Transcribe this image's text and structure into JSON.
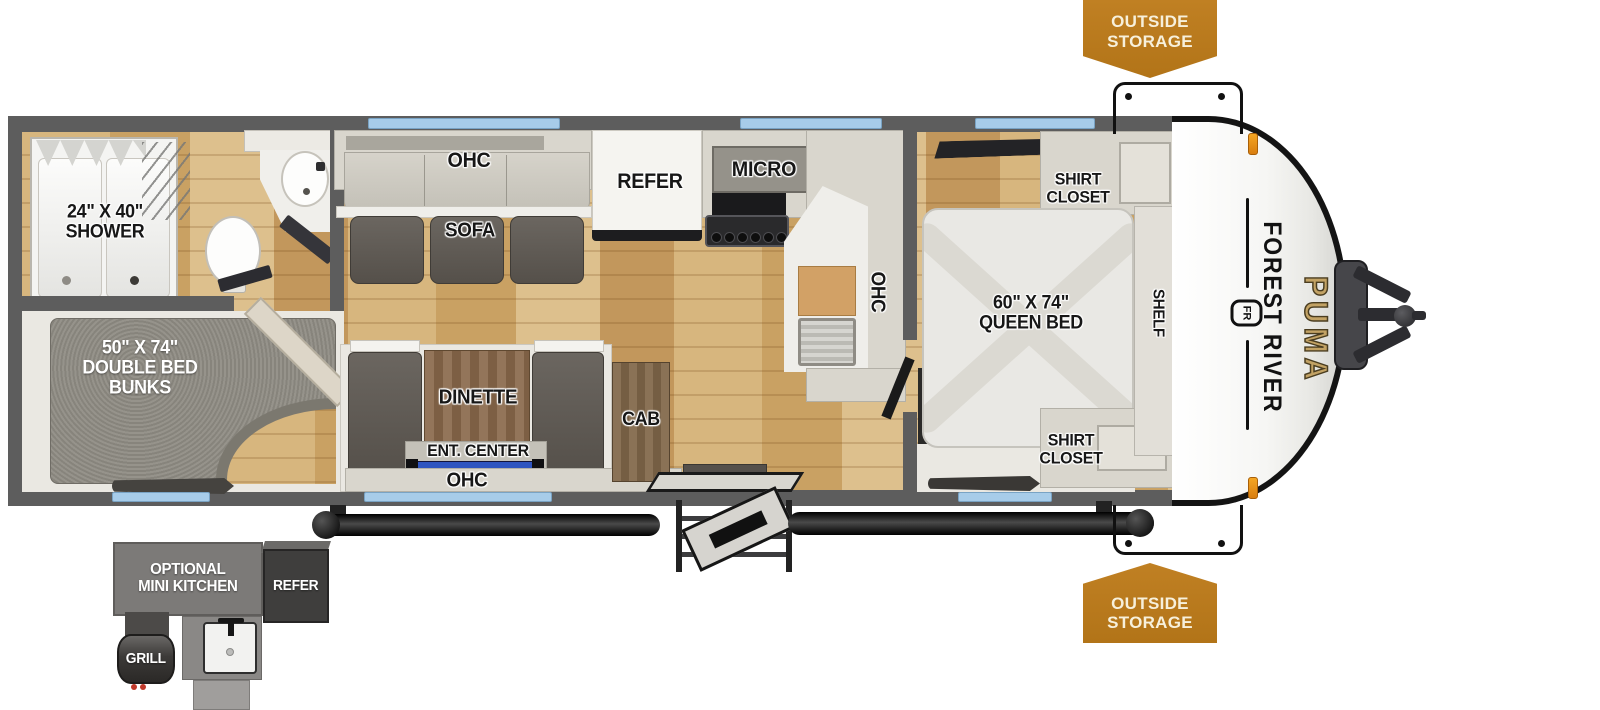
{
  "title": "Forest River Puma travel trailer floorplan",
  "colors": {
    "badge_orange": "#bd7b22",
    "window_blue": "#a7cce9",
    "wall_gray": "#5d5d5d",
    "wood_tan": "#d2ad74",
    "carpet_gray": "#8f8c84",
    "puma_gold": "#c2a264",
    "tv_blue": "#2f55c0"
  },
  "badges": {
    "outside_storage": "OUTSIDE\nSTORAGE"
  },
  "rooms": {
    "bathroom": {
      "shower": "24\" X 40\"\nSHOWER"
    },
    "bunk_room": {
      "bunks": "50\" X 74\"\nDOUBLE BED\nBUNKS"
    },
    "living": {
      "ohc_top": "OHC",
      "sofa": "SOFA",
      "refer": "REFER",
      "micro": "MICRO",
      "ohc_kitchen": "OHC",
      "dinette": "DINETTE",
      "ent_center": "ENT. CENTER",
      "cab": "CAB",
      "ohc_bottom": "OHC"
    },
    "bedroom": {
      "shirt_closet_top": "SHIRT\nCLOSET",
      "shirt_closet_bottom": "SHIRT\nCLOSET",
      "queen_bed": "60\" X 74\"\nQUEEN BED",
      "shelf": "SHELF"
    }
  },
  "branding": {
    "make": "FOREST RIVER",
    "logo_monogram": "FR",
    "model": "PUMA"
  },
  "exterior_options": {
    "mini_kitchen": "OPTIONAL\nMINI KITCHEN",
    "refer": "REFER",
    "grill": "GRILL"
  }
}
